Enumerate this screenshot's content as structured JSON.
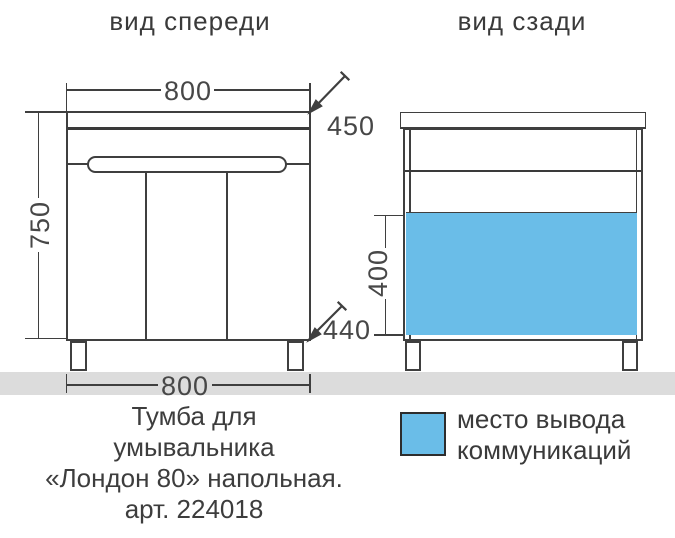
{
  "header": {
    "front_view_label": "вид спереди",
    "back_view_label": "вид сзади"
  },
  "front_view": {
    "dim_width_top": "800",
    "dim_depth_top": "450",
    "dim_height": "750",
    "dim_depth_bottom": "440",
    "dim_width_bottom": "800"
  },
  "back_view": {
    "dim_cutout_height": "400"
  },
  "legend": {
    "swatch": "cutout-area-swatch",
    "lines": [
      "место вывода",
      "коммуникаций"
    ]
  },
  "caption": {
    "lines": [
      "Тумба для",
      "умывальника",
      "«Лондон 80» напольная.",
      "арт. 224018"
    ]
  },
  "colors": {
    "line": "#3f3f3f",
    "floor": "#dcdcdc",
    "cutout_blue": "#6abde8",
    "background": "#ffffff"
  }
}
